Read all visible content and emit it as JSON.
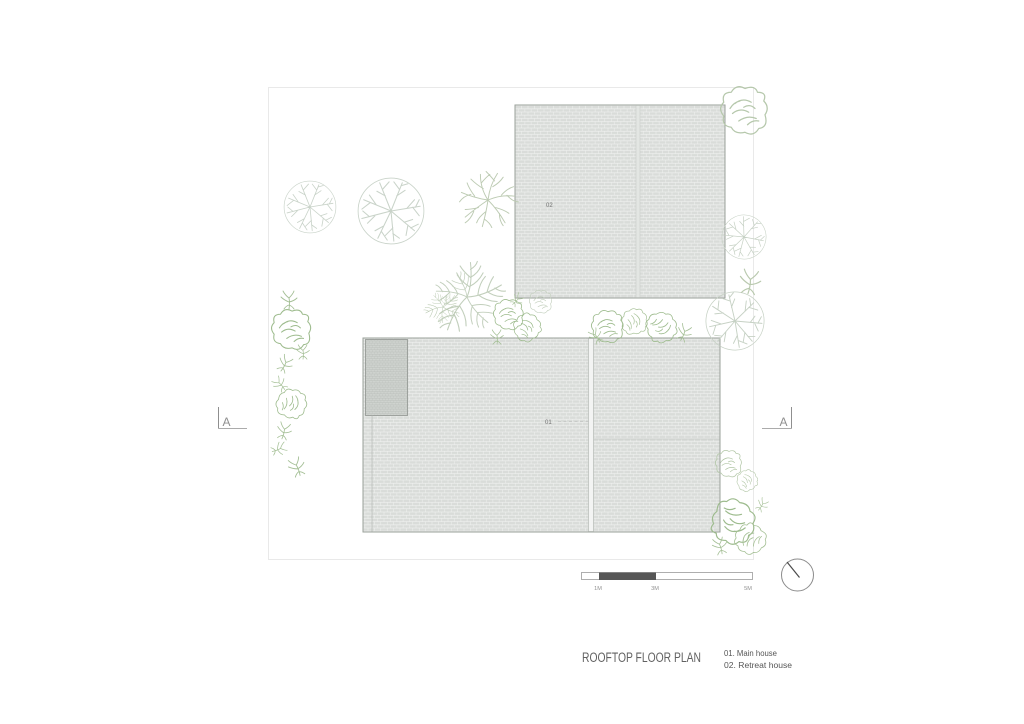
{
  "drawing": {
    "title": "ROOFTOP FLOOR PLAN",
    "legend": [
      "01. Main house",
      "02. Retreat house"
    ],
    "roof_labels": {
      "main": "01",
      "retreat": "02"
    },
    "section_markers": {
      "left": "A",
      "right": "A"
    },
    "scale_bar": {
      "labels": [
        "1M",
        "3M",
        "5M"
      ]
    },
    "icons": {
      "north_indicator": "circle-with-needle",
      "vegetation_glyphs": [
        "radial-tree",
        "branch-tree",
        "scribble-shrub",
        "twig-sprig",
        "leaf-plant"
      ]
    },
    "colors": {
      "background": "#ffffff",
      "roof_tile": "#d9dcd9",
      "roof_tile_joint": "#f2f3f2",
      "roof_dark_patch": "#cfd3cf",
      "roof_outline": "#9aa09a",
      "site_boundary": "#e9e9e9",
      "tree_stroke": "#c9d3c9",
      "shrub_stroke": "#9dbb8d",
      "title_text": "#616161",
      "scale_dark": "#565656",
      "marker_gray": "#8f8f8f"
    }
  }
}
